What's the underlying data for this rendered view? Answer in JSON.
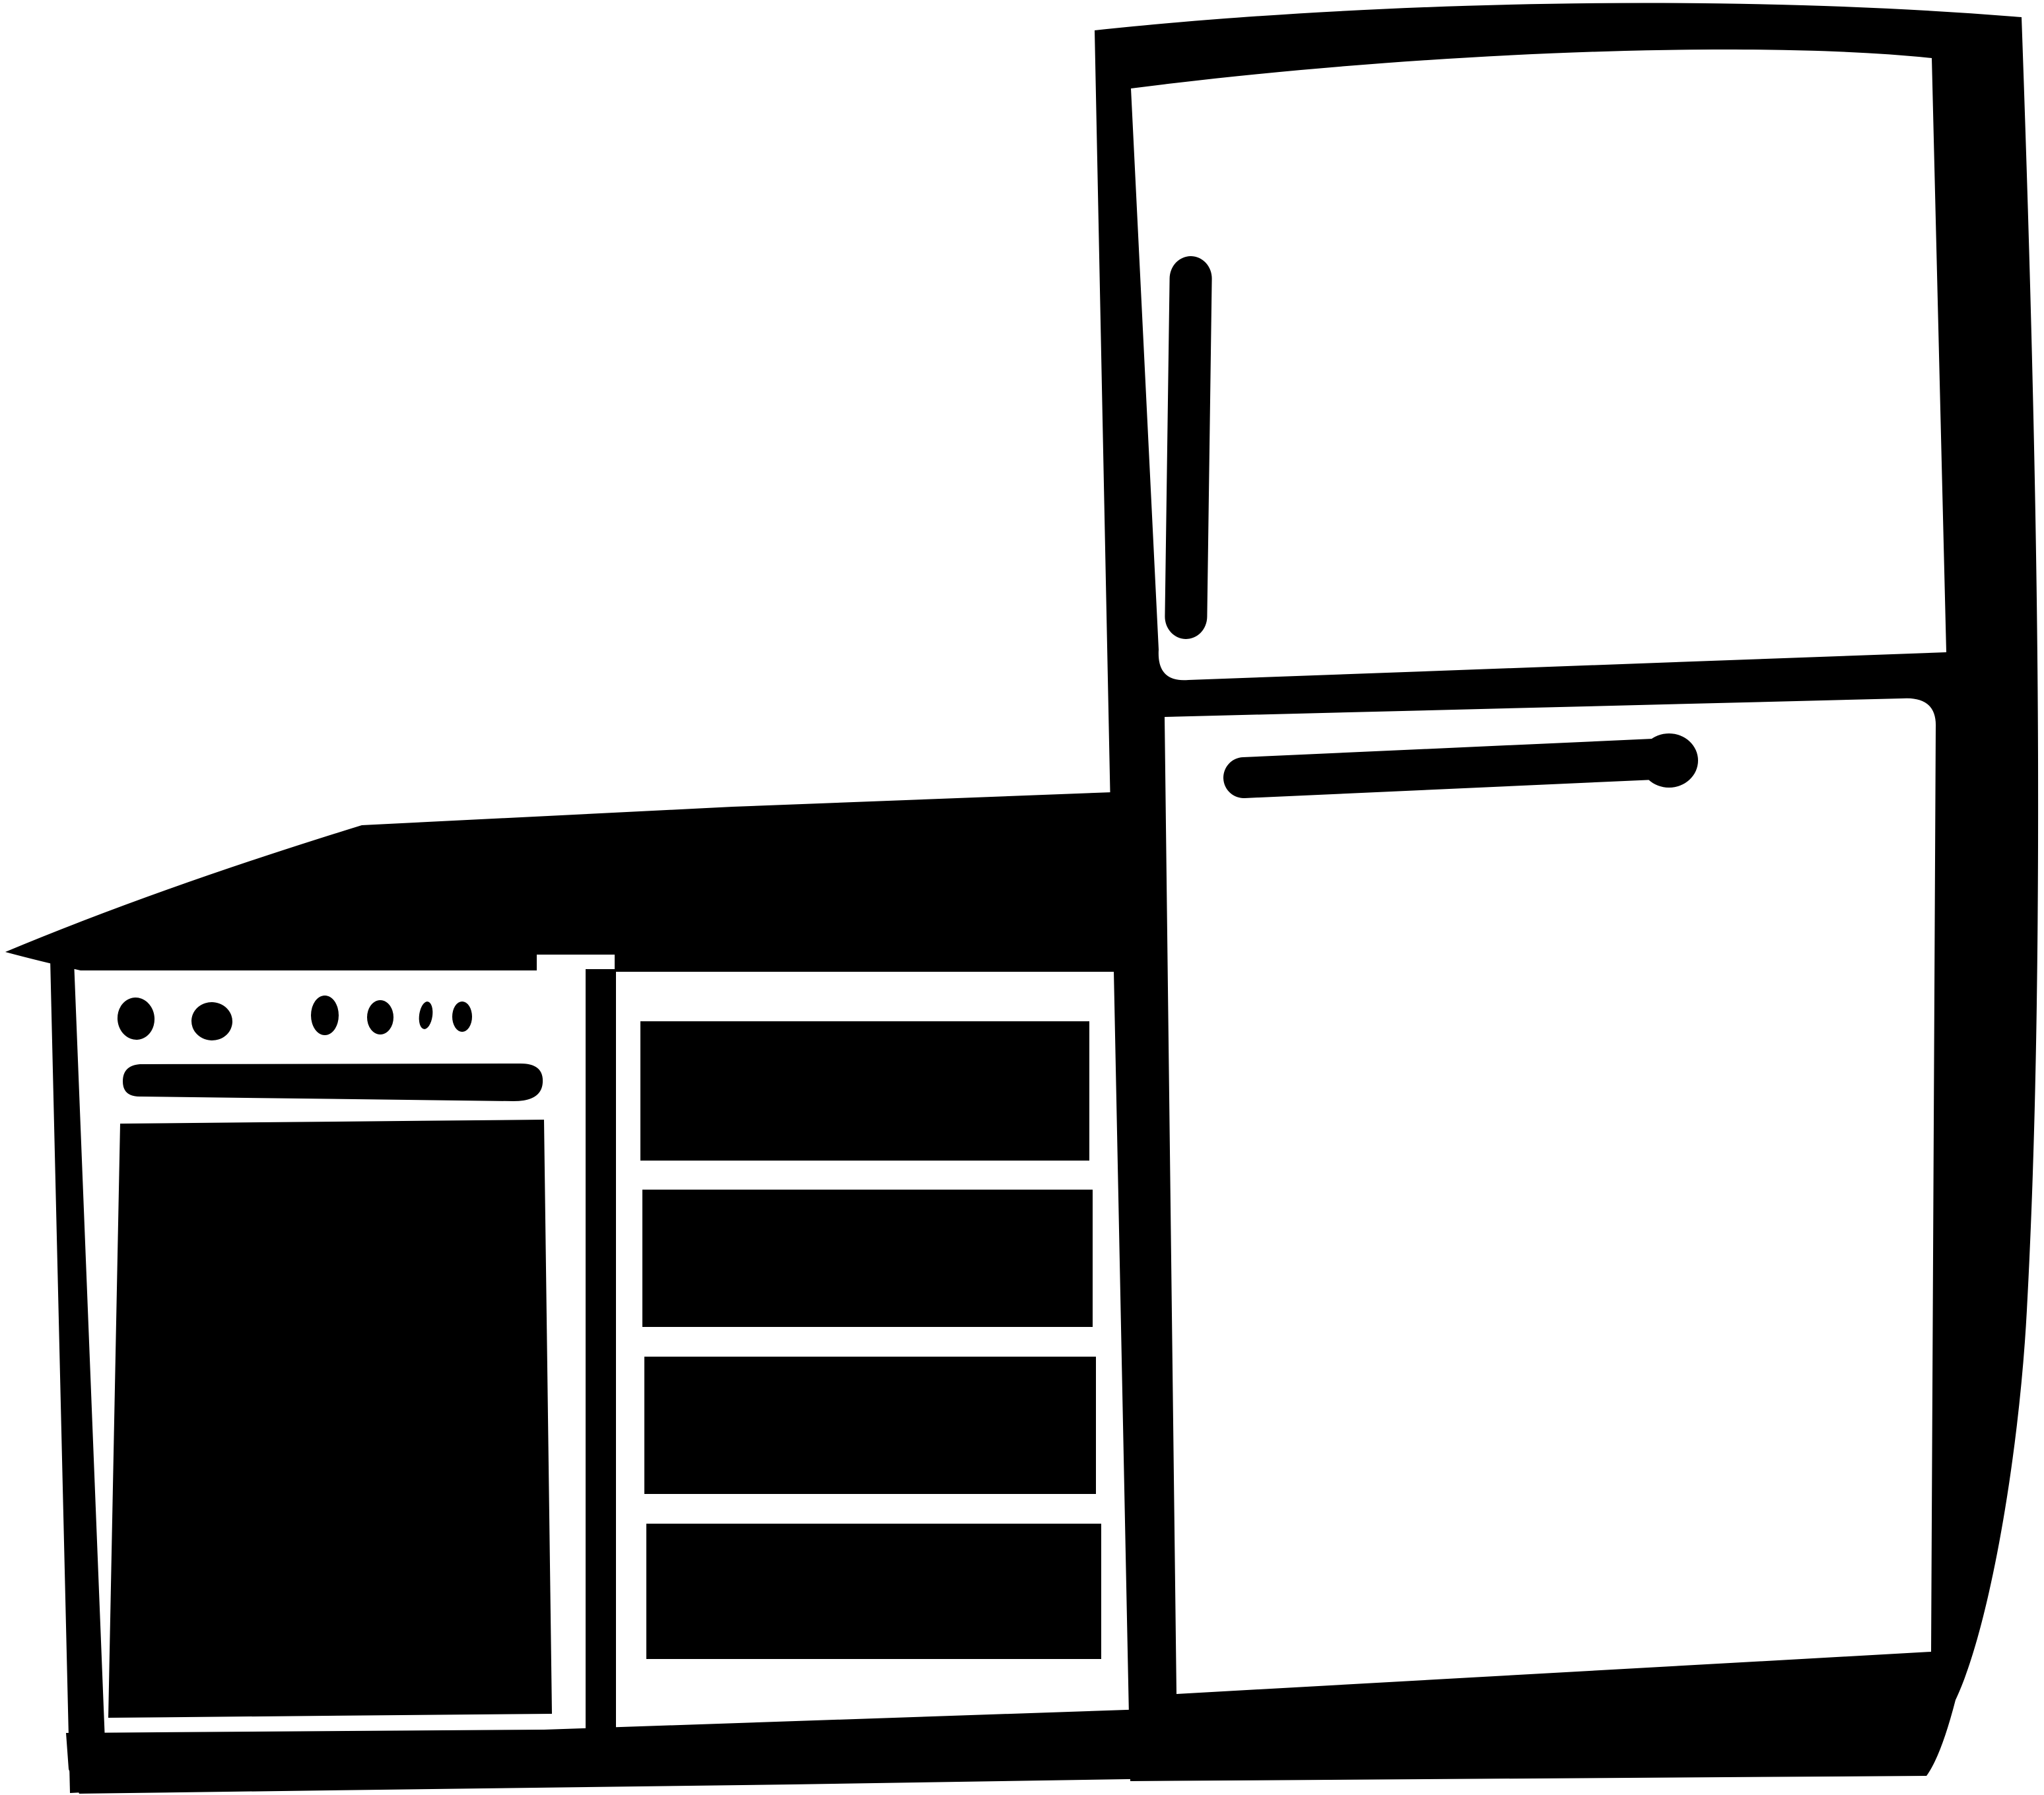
{
  "title": "Black and white kitchen clipart: stove, drawer cabinet and two-door refrigerator",
  "description": "Monochrome silhouette illustration of a kitchen corner. A countertop runs over a stove and a cabinet with drawers; a tall refrigerator with a freezer compartment stands to the right.",
  "colors": {
    "ink": "#000000",
    "paper": "#ffffff"
  },
  "scene": {
    "style": "hand-drawn monochrome clipart",
    "countertop": {
      "label": "countertop"
    },
    "stove": {
      "label": "stove with oven",
      "knob_count": 6,
      "parts": [
        "control knobs",
        "broiler slot",
        "oven door"
      ]
    },
    "drawer_cabinet": {
      "label": "drawer cabinet",
      "drawer_count": 4
    },
    "refrigerator": {
      "label": "two-door refrigerator",
      "parts": [
        "freezer door",
        "freezer door handle",
        "fridge door",
        "fridge door handle"
      ]
    }
  }
}
